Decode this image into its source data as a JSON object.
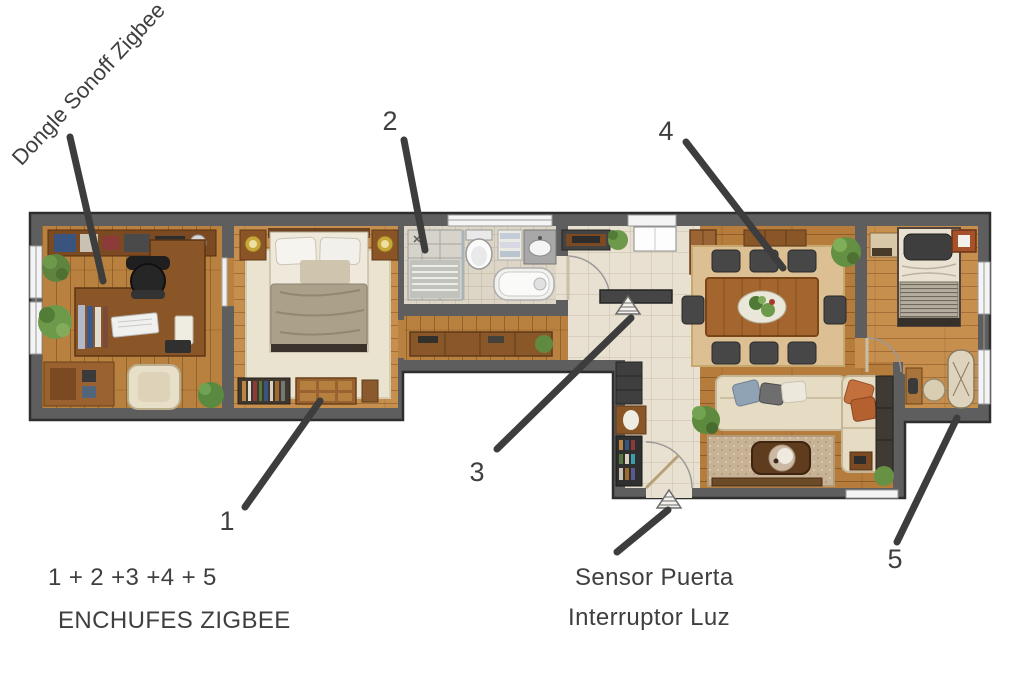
{
  "annotations": {
    "dongle": "Dongle Sonoff Zigbee",
    "markers": [
      "1",
      "2",
      "3",
      "4",
      "5"
    ],
    "formula": "1 + 2 +3 +4 + 5",
    "title": "ENCHUFES ZIGBEE",
    "door_sensor": "Sensor Puerta",
    "light_switch": "Interruptor Luz"
  },
  "icons": {
    "hall_sensor": "hatched-triangle-sensor",
    "door_sensor": "hatched-triangle-sensor"
  },
  "colors": {
    "background": "#ffffff",
    "wall": "#5e5e5e",
    "wall_outline": "#2e2e2e",
    "wood_floor": "#b9813f",
    "wood_floor_light": "#c68f4e",
    "tile_floor": "#e8e0d0",
    "bath_tile": "#ddd5c5",
    "annotation_text": "#3f3f3f",
    "leader_line": "#3d3d3d",
    "rug_cream": "#eae3d0",
    "rug_tan": "#dcbf92",
    "sofa_cream": "#e6dcc4",
    "accent_orange": "#c4703c",
    "plant_green": "#6d9a4a"
  }
}
